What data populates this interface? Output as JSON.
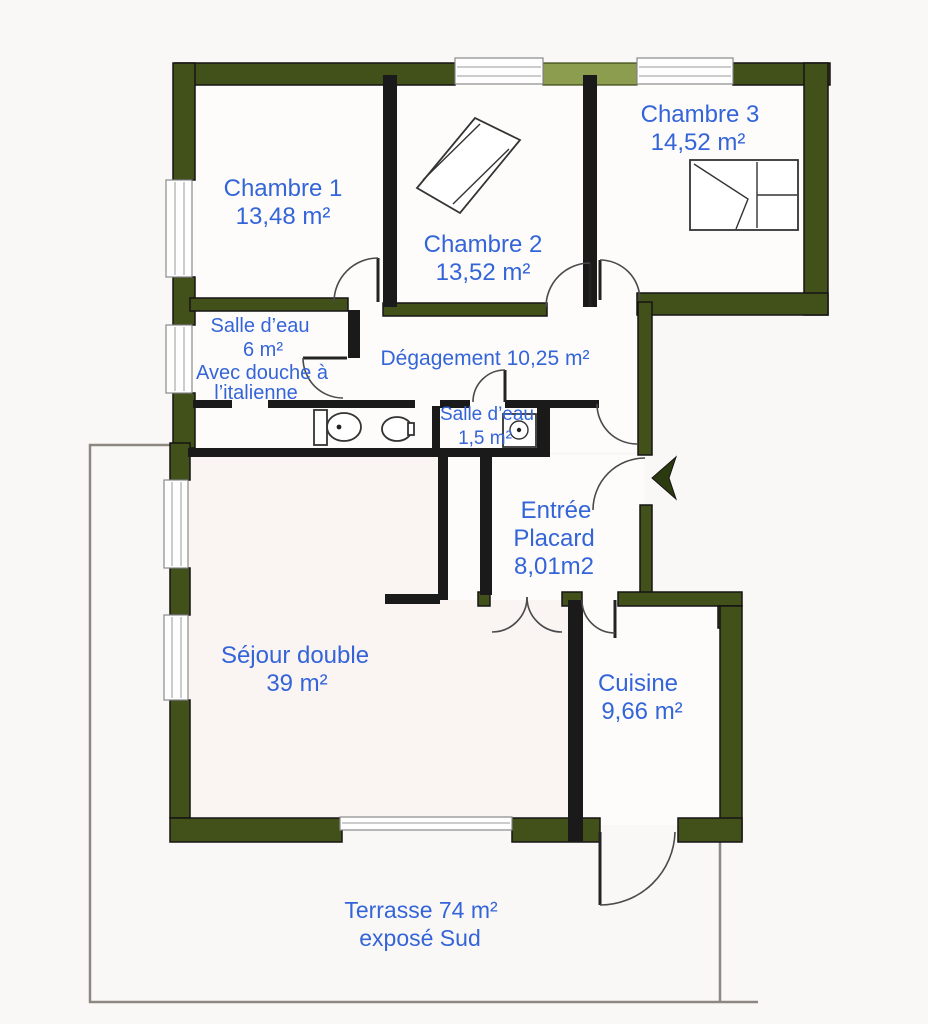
{
  "document": {
    "type": "floor-plan",
    "style": "scanned real-estate apartment plan"
  },
  "colors": {
    "load_bearing_wall_green": "#42511a",
    "shutter_box_light_green": "#8d9d4f",
    "partition_black": "#1a1a1a",
    "label_blue": "#3465d8",
    "paper_background": "#faf8f7"
  },
  "icons": {
    "entrance_arrow": "solid left-pointing arrow at front door",
    "toilet": "wc with cistern",
    "washbasin": "small oval basin",
    "shower": "square tray with drain",
    "bed": "double bed with pillows",
    "rug": "tilted rectangle in Chambre 2"
  },
  "rooms": [
    {
      "id": "chambre1",
      "label": "Chambre 1",
      "area": "13,48 m²"
    },
    {
      "id": "chambre2",
      "label": "Chambre 2",
      "area": "13,52 m²"
    },
    {
      "id": "chambre3",
      "label": "Chambre 3",
      "area": "14,52 m²"
    },
    {
      "id": "salle_deau_6",
      "label": "Salle d’eau",
      "area": "6 m²",
      "note_line1": "Avec douche à",
      "note_line2": "l’italienne"
    },
    {
      "id": "degagement",
      "label": "Dégagement 10,25 m²"
    },
    {
      "id": "salle_deau_1_5",
      "label": "Salle d’eau",
      "area": "1,5 m²"
    },
    {
      "id": "entree",
      "label": "Entrée",
      "label2": "Placard",
      "area": "8,01m2"
    },
    {
      "id": "sejour",
      "label": "Séjour double",
      "area": "39 m²"
    },
    {
      "id": "cuisine",
      "label": "Cuisine",
      "area": "9,66 m²"
    },
    {
      "id": "terrasse",
      "label": "Terrasse 74 m²",
      "note": "exposé Sud"
    }
  ]
}
